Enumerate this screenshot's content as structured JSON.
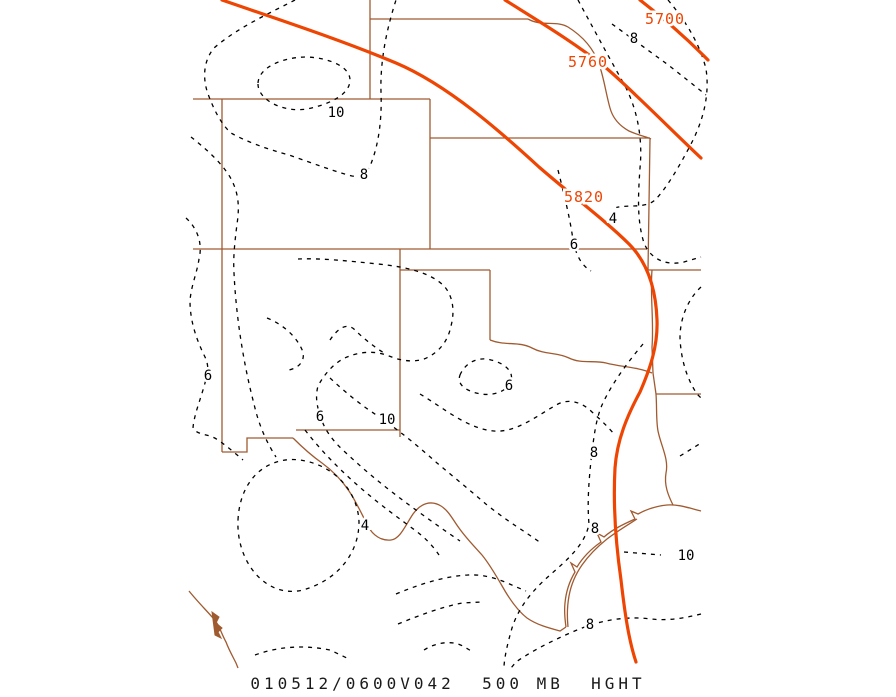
{
  "title": "500 MB height contour map",
  "caption": "010512/0600V042  500 MB  HGHT",
  "colors": {
    "state_border": "#a05a30",
    "height_contour": "#ee4503",
    "dashed_contour": "#000000",
    "background": "#ffffff"
  },
  "chart_data": {
    "type": "contour-map",
    "parameter": "500 MB HGHT",
    "valid_time_label": "010512/0600V042",
    "height_contours_m": [
      5700,
      5760,
      5820
    ],
    "height_contour_interval": 60,
    "dashed_contour_values": [
      4,
      6,
      8,
      10
    ],
    "dashed_contour_interval": 2
  },
  "height_contour_labels": [
    {
      "text": "5700",
      "x": 665,
      "y": 24
    },
    {
      "text": "5760",
      "x": 588,
      "y": 67
    },
    {
      "text": "5820",
      "x": 584,
      "y": 202
    }
  ],
  "dashed_contour_labels": [
    {
      "text": "8",
      "x": 634,
      "y": 43
    },
    {
      "text": "10",
      "x": 336,
      "y": 117
    },
    {
      "text": "8",
      "x": 364,
      "y": 179
    },
    {
      "text": "4",
      "x": 613,
      "y": 223
    },
    {
      "text": "6",
      "x": 574,
      "y": 249
    },
    {
      "text": "6",
      "x": 208,
      "y": 380
    },
    {
      "text": "6",
      "x": 320,
      "y": 421
    },
    {
      "text": "10",
      "x": 387,
      "y": 424
    },
    {
      "text": "6",
      "x": 509,
      "y": 390
    },
    {
      "text": "8",
      "x": 594,
      "y": 457
    },
    {
      "text": "8",
      "x": 595,
      "y": 533
    },
    {
      "text": "4",
      "x": 365,
      "y": 530
    },
    {
      "text": "10",
      "x": 686,
      "y": 560
    },
    {
      "text": "8",
      "x": 590,
      "y": 629
    }
  ]
}
